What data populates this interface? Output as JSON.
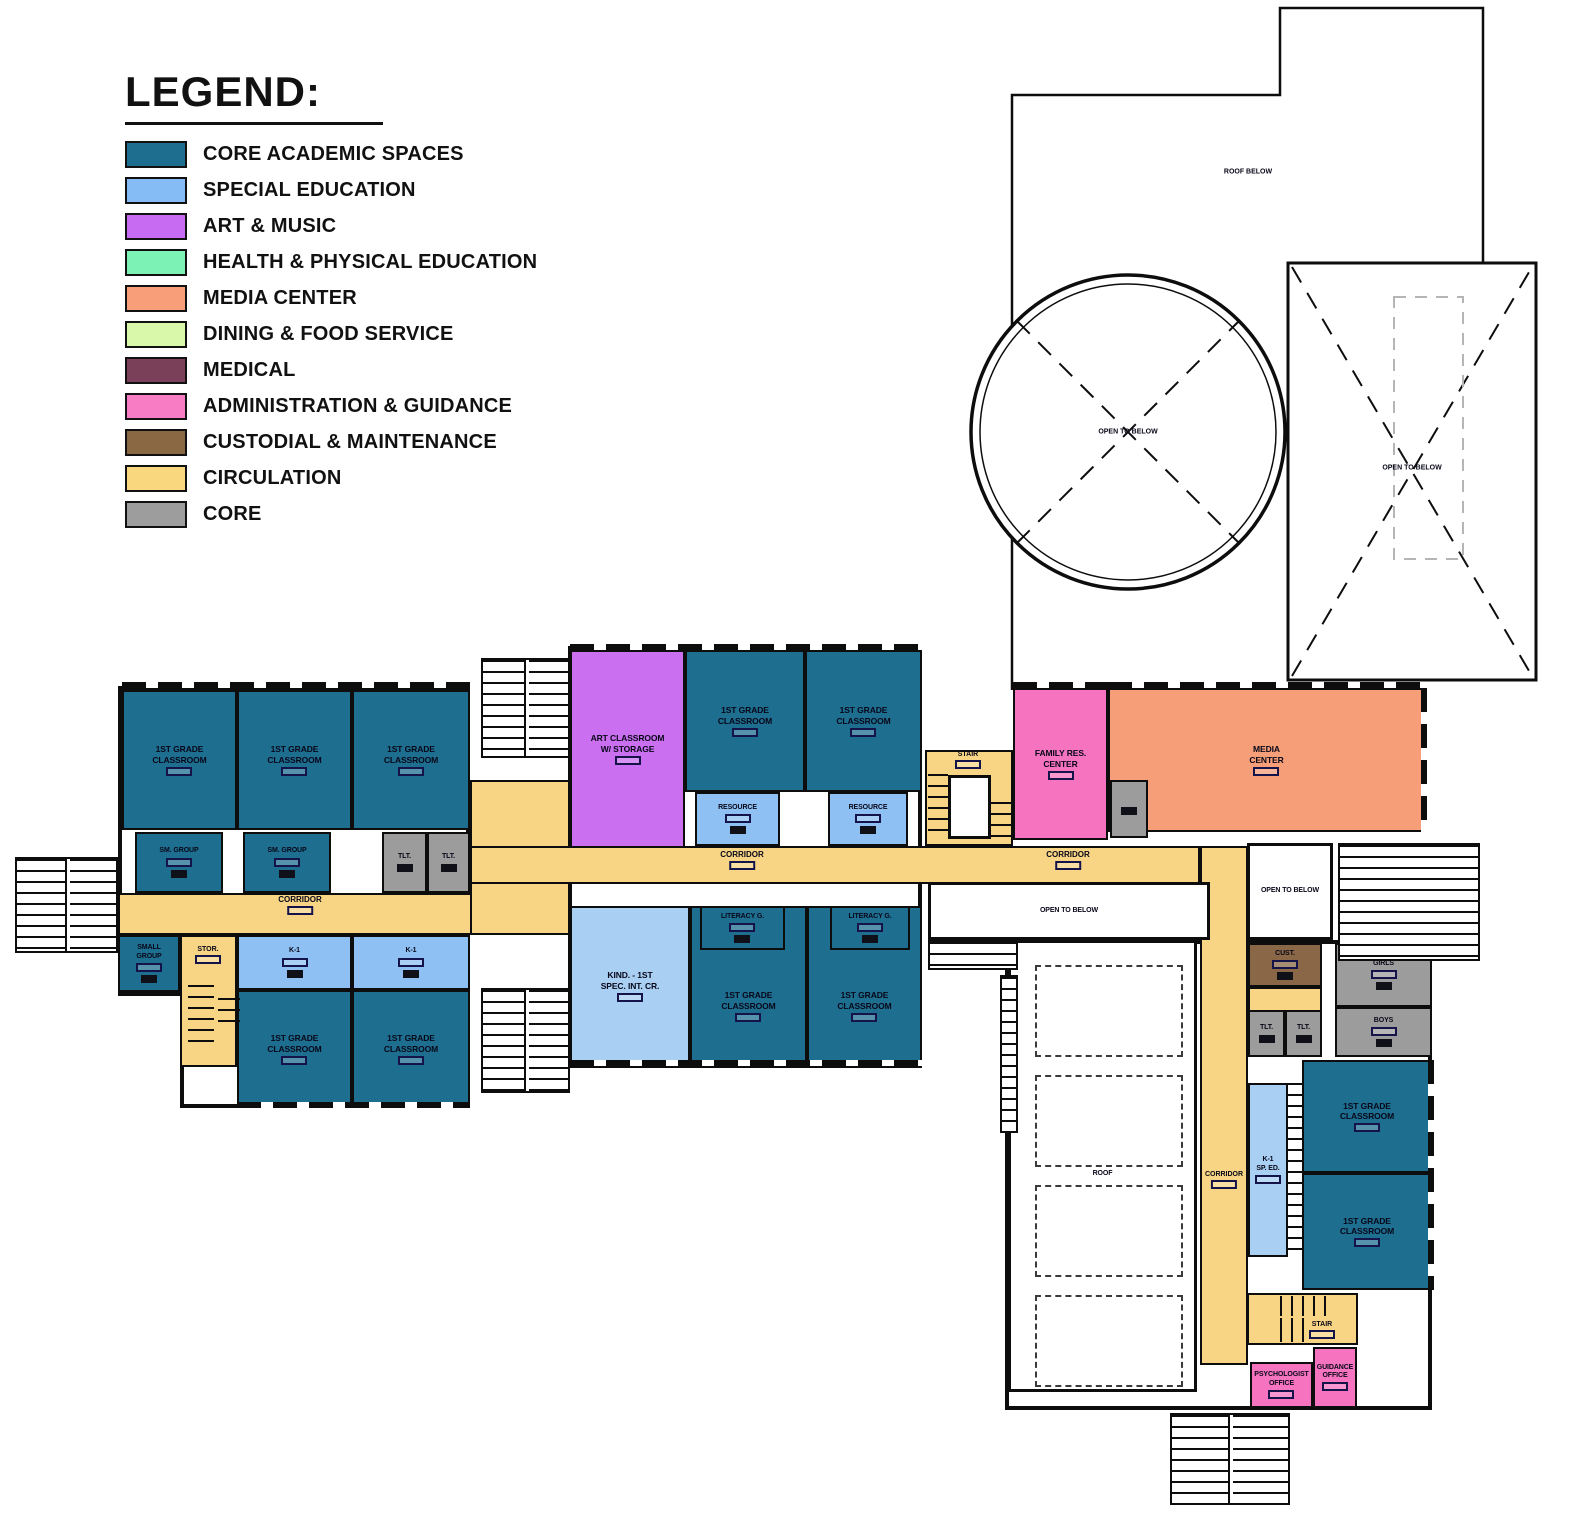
{
  "legend": {
    "title": "LEGEND:",
    "items": [
      {
        "label": "CORE ACADEMIC SPACES",
        "color": "#1E6E90"
      },
      {
        "label": "SPECIAL EDUCATION",
        "color": "#85BCF5"
      },
      {
        "label": "ART & MUSIC",
        "color": "#C76BF2"
      },
      {
        "label": "HEALTH & PHYSICAL EDUCATION",
        "color": "#7DF2B5"
      },
      {
        "label": "MEDIA CENTER",
        "color": "#F89E79"
      },
      {
        "label": "DINING & FOOD SERVICE",
        "color": "#D9F8A9"
      },
      {
        "label": "MEDICAL",
        "color": "#7B4059"
      },
      {
        "label": "ADMINISTRATION & GUIDANCE",
        "color": "#F77CC4"
      },
      {
        "label": "CUSTODIAL & MAINTENANCE",
        "color": "#8B6844"
      },
      {
        "label": "CIRCULATION",
        "color": "#F9D77F"
      },
      {
        "label": "CORE",
        "color": "#9D9D9D"
      }
    ]
  },
  "plan": {
    "canvas": {
      "w": 1582,
      "h": 1520
    },
    "palette": {
      "core": "#1E6E90",
      "sped": "#8FC0F3",
      "sped2": "#A9CFF3",
      "art": "#C96FF0",
      "admin": "#F573BF",
      "media": "#F59E78",
      "cust": "#8A6746",
      "gray": "#9C9C9C",
      "circ": "#F8D584",
      "open": "#FFFFFF"
    },
    "walls": [
      {
        "r": [
          118,
          686,
          352,
          310
        ]
      },
      {
        "r": [
          180,
          935,
          290,
          173
        ]
      },
      {
        "r": [
          568,
          646,
          354,
          422
        ]
      },
      {
        "r": [
          1005,
          940,
          427,
          470
        ]
      }
    ],
    "circulation": [
      {
        "r": [
          118,
          893,
          452,
          42
        ]
      },
      {
        "r": [
          470,
          780,
          100,
          155
        ]
      },
      {
        "r": [
          470,
          846,
          730,
          38
        ]
      },
      {
        "r": [
          1200,
          846,
          48,
          519
        ]
      },
      {
        "r": [
          1248,
          987,
          74,
          25
        ]
      },
      {
        "r": [
          180,
          935,
          57,
          132
        ]
      },
      {
        "r": [
          925,
          750,
          88,
          96
        ]
      }
    ],
    "rooms": [
      {
        "label": "1ST GRADE\nCLASSROOM",
        "type": "core",
        "r": [
          122,
          690,
          115,
          140
        ],
        "tag": 1
      },
      {
        "label": "1ST GRADE\nCLASSROOM",
        "type": "core",
        "r": [
          237,
          690,
          115,
          140
        ],
        "tag": 1
      },
      {
        "label": "1ST GRADE\nCLASSROOM",
        "type": "core",
        "r": [
          352,
          690,
          118,
          140
        ],
        "tag": 1
      },
      {
        "label": "SM. GROUP",
        "type": "core",
        "r": [
          135,
          832,
          88,
          61
        ],
        "tag": 1,
        "small": 1,
        "furn": 1
      },
      {
        "label": "SM. GROUP",
        "type": "core",
        "r": [
          243,
          832,
          88,
          61
        ],
        "tag": 1,
        "small": 1,
        "furn": 1
      },
      {
        "label": "TLT.",
        "type": "gray",
        "r": [
          382,
          832,
          45,
          61
        ],
        "small": 1,
        "furn": 1
      },
      {
        "label": "TLT.",
        "type": "gray",
        "r": [
          427,
          832,
          43,
          61
        ],
        "small": 1,
        "furn": 1
      },
      {
        "label": "SMALL\nGROUP",
        "type": "core",
        "r": [
          118,
          935,
          62,
          57
        ],
        "tag": 1,
        "small": 1,
        "furn": 1
      },
      {
        "label": "K-1",
        "type": "sped",
        "r": [
          237,
          935,
          115,
          55
        ],
        "tag": 1,
        "small": 1,
        "furn": 1
      },
      {
        "label": "K-1",
        "type": "sped",
        "r": [
          352,
          935,
          118,
          55
        ],
        "tag": 1,
        "small": 1,
        "furn": 1
      },
      {
        "label": "1ST GRADE\nCLASSROOM",
        "type": "core",
        "r": [
          237,
          990,
          115,
          118
        ],
        "tag": 1
      },
      {
        "label": "1ST GRADE\nCLASSROOM",
        "type": "core",
        "r": [
          352,
          990,
          118,
          118
        ],
        "tag": 1
      },
      {
        "label": "ART CLASSROOM\nW/ STORAGE",
        "type": "art",
        "r": [
          570,
          650,
          115,
          198
        ],
        "tag": 1
      },
      {
        "label": "1ST GRADE\nCLASSROOM",
        "type": "core",
        "r": [
          685,
          650,
          120,
          142
        ],
        "tag": 1
      },
      {
        "label": "1ST GRADE\nCLASSROOM",
        "type": "core",
        "r": [
          805,
          650,
          117,
          142
        ],
        "tag": 1
      },
      {
        "label": "RESOURCE",
        "type": "sped",
        "r": [
          695,
          792,
          85,
          54
        ],
        "tag": 1,
        "small": 1,
        "furn": 1
      },
      {
        "label": "RESOURCE",
        "type": "sped",
        "r": [
          828,
          792,
          80,
          54
        ],
        "tag": 1,
        "small": 1,
        "furn": 1
      },
      {
        "label": "KIND. - 1ST\nSPEC. INT. CR.",
        "type": "sped2",
        "r": [
          570,
          906,
          120,
          160
        ],
        "tag": 1
      },
      {
        "label": "1ST GRADE\nCLASSROOM",
        "type": "core",
        "r": [
          690,
          906,
          117,
          160
        ],
        "tag": 1,
        "dy": 20
      },
      {
        "label": "1ST GRADE\nCLASSROOM",
        "type": "core",
        "r": [
          807,
          906,
          115,
          160
        ],
        "tag": 1,
        "dy": 20
      },
      {
        "label": "LITERACY G.",
        "type": "core",
        "r": [
          700,
          906,
          85,
          44
        ],
        "tag": 1,
        "small": 1,
        "furn": 1
      },
      {
        "label": "LITERACY G.",
        "type": "core",
        "r": [
          830,
          906,
          80,
          44
        ],
        "tag": 1,
        "small": 1,
        "furn": 1
      },
      {
        "label": "FAMILY RES.\nCENTER",
        "type": "admin",
        "r": [
          1013,
          688,
          95,
          152
        ],
        "tag": 1
      },
      {
        "label": "MEDIA\nCENTER",
        "type": "media",
        "r": [
          1108,
          688,
          317,
          144
        ],
        "tag": 1
      },
      {
        "label": "",
        "type": "gray",
        "r": [
          1110,
          780,
          38,
          58
        ],
        "furn": 1
      },
      {
        "label": "",
        "type": "open",
        "r": [
          948,
          775,
          43,
          64
        ]
      },
      {
        "label": "OPEN TO BELOW",
        "type": "open",
        "r": [
          928,
          882,
          282,
          58
        ],
        "small": 1
      },
      {
        "label": "OPEN TO BELOW",
        "type": "open",
        "r": [
          1247,
          843,
          86,
          97
        ],
        "small": 1
      },
      {
        "label": "POSSIBLE\nVEGETATIVE\nROOF",
        "type": "open",
        "r": [
          1008,
          940,
          189,
          452
        ],
        "small": 1
      },
      {
        "label": "CUST.",
        "type": "cust",
        "r": [
          1248,
          943,
          74,
          44
        ],
        "tag": 1,
        "small": 1,
        "furn": 1
      },
      {
        "label": "GIRLS",
        "type": "gray",
        "r": [
          1335,
          943,
          97,
          64
        ],
        "tag": 1,
        "small": 1,
        "furn": 1
      },
      {
        "label": "BOYS",
        "type": "gray",
        "r": [
          1335,
          1007,
          97,
          50
        ],
        "tag": 1,
        "small": 1,
        "furn": 1
      },
      {
        "label": "TLT.",
        "type": "gray",
        "r": [
          1248,
          1010,
          37,
          47
        ],
        "small": 1,
        "furn": 1
      },
      {
        "label": "TLT.",
        "type": "gray",
        "r": [
          1285,
          1010,
          37,
          47
        ],
        "small": 1,
        "furn": 1
      },
      {
        "label": "K-1\nSP. ED.",
        "type": "sped2",
        "r": [
          1248,
          1083,
          40,
          174
        ],
        "tag": 1,
        "small": 1
      },
      {
        "label": "1ST GRADE\nCLASSROOM",
        "type": "core",
        "r": [
          1302,
          1060,
          130,
          113
        ],
        "tag": 1
      },
      {
        "label": "1ST GRADE\nCLASSROOM",
        "type": "core",
        "r": [
          1302,
          1173,
          130,
          117
        ],
        "tag": 1
      },
      {
        "label": "",
        "type": "circ",
        "r": [
          1247,
          1293,
          111,
          52
        ]
      },
      {
        "label": "PSYCHOLOGIST\nOFFICE",
        "type": "admin",
        "r": [
          1250,
          1362,
          63,
          46
        ],
        "tag": 1,
        "small": 1
      },
      {
        "label": "GUIDANCE\nOFFICE",
        "type": "admin",
        "r": [
          1313,
          1347,
          44,
          61
        ],
        "tag": 1,
        "small": 1
      }
    ],
    "dashed_panels": [
      {
        "r": [
          1035,
          965,
          148,
          92
        ]
      },
      {
        "r": [
          1035,
          1075,
          148,
          92
        ]
      },
      {
        "r": [
          1035,
          1185,
          148,
          92
        ]
      },
      {
        "r": [
          1035,
          1295,
          148,
          92
        ]
      }
    ],
    "stairs": [
      {
        "r": [
          15,
          857,
          103,
          96
        ],
        "dir": "h",
        "rail": "v"
      },
      {
        "r": [
          481,
          658,
          89,
          100
        ],
        "dir": "h",
        "rail": "v"
      },
      {
        "r": [
          481,
          988,
          89,
          105
        ],
        "dir": "h",
        "rail": "v"
      },
      {
        "r": [
          1338,
          843,
          142,
          118
        ],
        "dir": "h"
      },
      {
        "r": [
          1170,
          1413,
          120,
          92
        ],
        "dir": "h",
        "rail": "v"
      },
      {
        "r": [
          928,
          940,
          90,
          30
        ],
        "dir": "h"
      },
      {
        "r": [
          1000,
          975,
          18,
          158
        ],
        "dir": "h"
      },
      {
        "r": [
          928,
          774,
          20,
          66
        ],
        "dir": "h",
        "t": 1
      },
      {
        "r": [
          991,
          802,
          20,
          38
        ],
        "dir": "h",
        "t": 1
      },
      {
        "r": [
          188,
          985,
          26,
          62
        ],
        "dir": "h",
        "t": 1
      },
      {
        "r": [
          218,
          998,
          22,
          32
        ],
        "dir": "h",
        "t": 1
      },
      {
        "r": [
          1288,
          1083,
          14,
          174
        ],
        "dir": "h",
        "t": 1
      },
      {
        "r": [
          1280,
          1296,
          54,
          20
        ],
        "dir": "v",
        "t": 1
      },
      {
        "r": [
          1280,
          1318,
          32,
          24
        ],
        "dir": "v",
        "t": 1
      }
    ],
    "windows": [
      {
        "r": [
          122,
          682,
          348,
          6
        ],
        "o": "h"
      },
      {
        "r": [
          237,
          1102,
          233,
          6
        ],
        "o": "h"
      },
      {
        "r": [
          570,
          644,
          352,
          6
        ],
        "o": "h"
      },
      {
        "r": [
          570,
          1060,
          352,
          6
        ],
        "o": "h"
      },
      {
        "r": [
          1108,
          682,
          317,
          6
        ],
        "o": "h"
      },
      {
        "r": [
          1013,
          682,
          95,
          6
        ],
        "o": "h"
      },
      {
        "r": [
          1428,
          1060,
          6,
          230
        ],
        "o": "v"
      },
      {
        "r": [
          1421,
          688,
          6,
          144
        ],
        "o": "v"
      }
    ],
    "labels": [
      {
        "text": "CORRIDOR",
        "x": 300,
        "y": 905,
        "tag": 1
      },
      {
        "text": "CORRIDOR",
        "x": 742,
        "y": 860,
        "tag": 1
      },
      {
        "text": "CORRIDOR",
        "x": 1068,
        "y": 860,
        "tag": 1
      },
      {
        "text": "CORRIDOR",
        "x": 1224,
        "y": 1180,
        "tag": 1,
        "small": 1
      },
      {
        "text": "STOR.",
        "x": 208,
        "y": 955,
        "tag": 1,
        "small": 1
      },
      {
        "text": "STAIR",
        "x": 968,
        "y": 760,
        "tag": 1,
        "small": 1
      },
      {
        "text": "STAIR",
        "x": 1322,
        "y": 1330,
        "tag": 1,
        "small": 1
      },
      {
        "text": "ROOF BELOW",
        "x": 1248,
        "y": 172,
        "small": 1
      },
      {
        "text": "OPEN TO BELOW",
        "x": 1128,
        "y": 432,
        "small": 1
      },
      {
        "text": "OPEN TO BELOW",
        "x": 1412,
        "y": 468,
        "small": 1
      }
    ]
  }
}
